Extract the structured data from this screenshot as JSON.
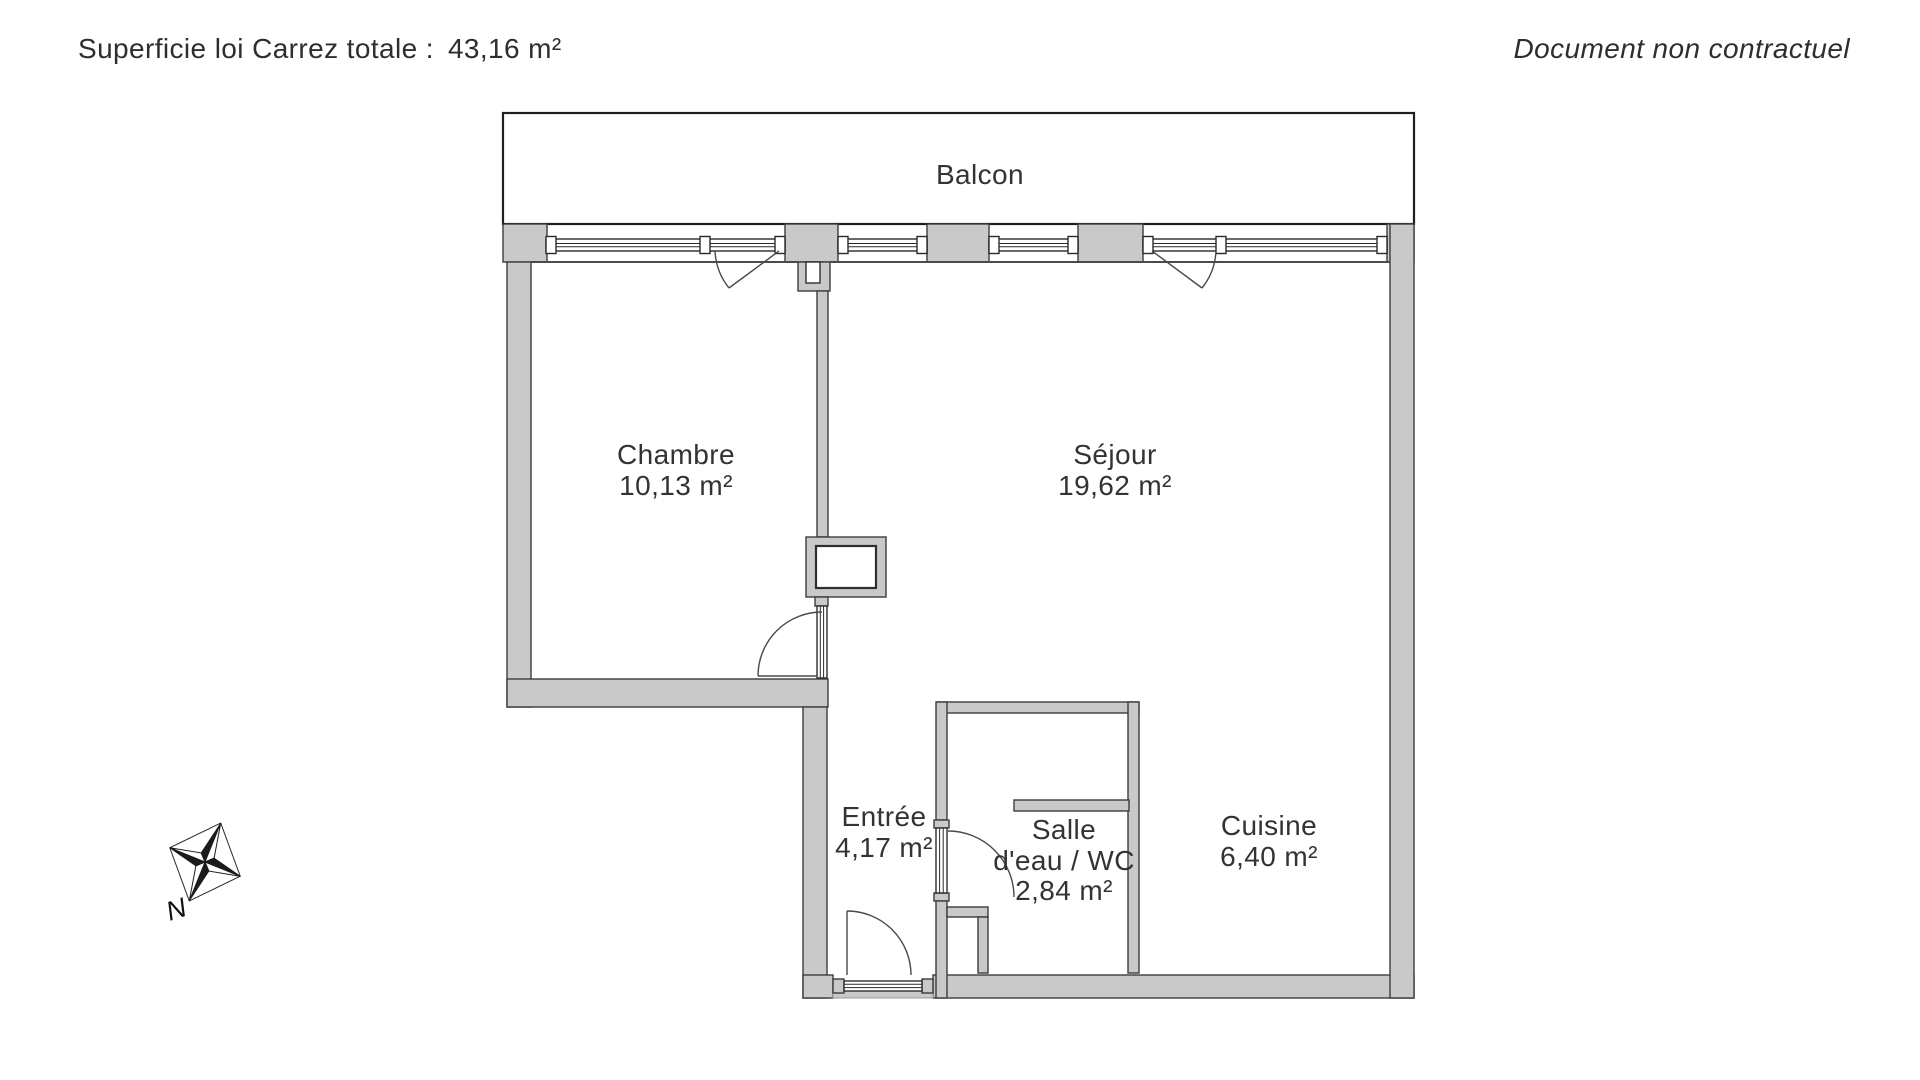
{
  "header": {
    "carrez_label": "Superficie loi Carrez totale :",
    "carrez_value": "43,16 m²",
    "disclaimer": "Document non contractuel"
  },
  "plan": {
    "balcony_label": "Balcon",
    "rooms": {
      "chambre": {
        "name": "Chambre",
        "area": "10,13 m²"
      },
      "sejour": {
        "name": "Séjour",
        "area": "19,62 m²"
      },
      "entree": {
        "name": "Entrée",
        "area": "4,17 m²"
      },
      "salle_eau": {
        "name_line1": "Salle",
        "name_line2": "d'eau / WC",
        "area": "2,84 m²"
      },
      "cuisine": {
        "name": "Cuisine",
        "area": "6,40 m²"
      }
    },
    "compass": {
      "north_label": "N"
    },
    "colors": {
      "wall_fill": "#c9c9c9",
      "wall_stroke": "#3c3c3c",
      "text": "#333333"
    }
  }
}
